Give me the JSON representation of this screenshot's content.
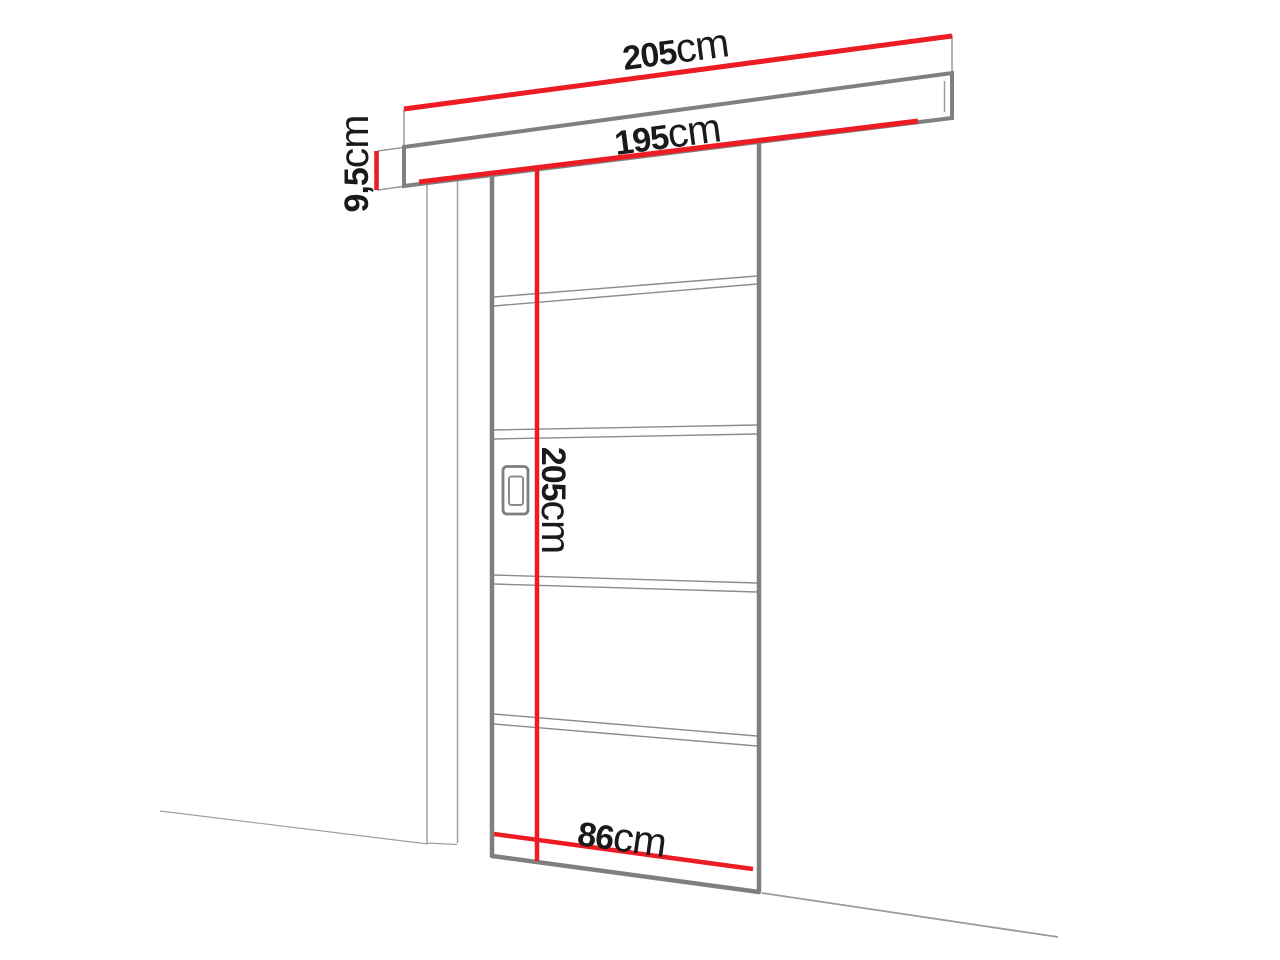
{
  "diagram": {
    "type": "sliding-door-technical-drawing",
    "labels": {
      "track_length": {
        "value": "205",
        "unit": "cm"
      },
      "pass_width": {
        "value": "195",
        "unit": "cm"
      },
      "track_height": {
        "value": "9,5",
        "unit": "cm"
      },
      "door_height": {
        "value": "205",
        "unit": "cm"
      },
      "door_width": {
        "value": "86",
        "unit": "cm"
      }
    },
    "colors": {
      "dimension_red": "#ed1c24",
      "outline_gray": "#7f7f7f",
      "thin_line_gray": "#9a9a9a",
      "panel_line_gray": "#8c8c8c",
      "text_black": "#1a1a1a",
      "background": "#ffffff"
    }
  }
}
